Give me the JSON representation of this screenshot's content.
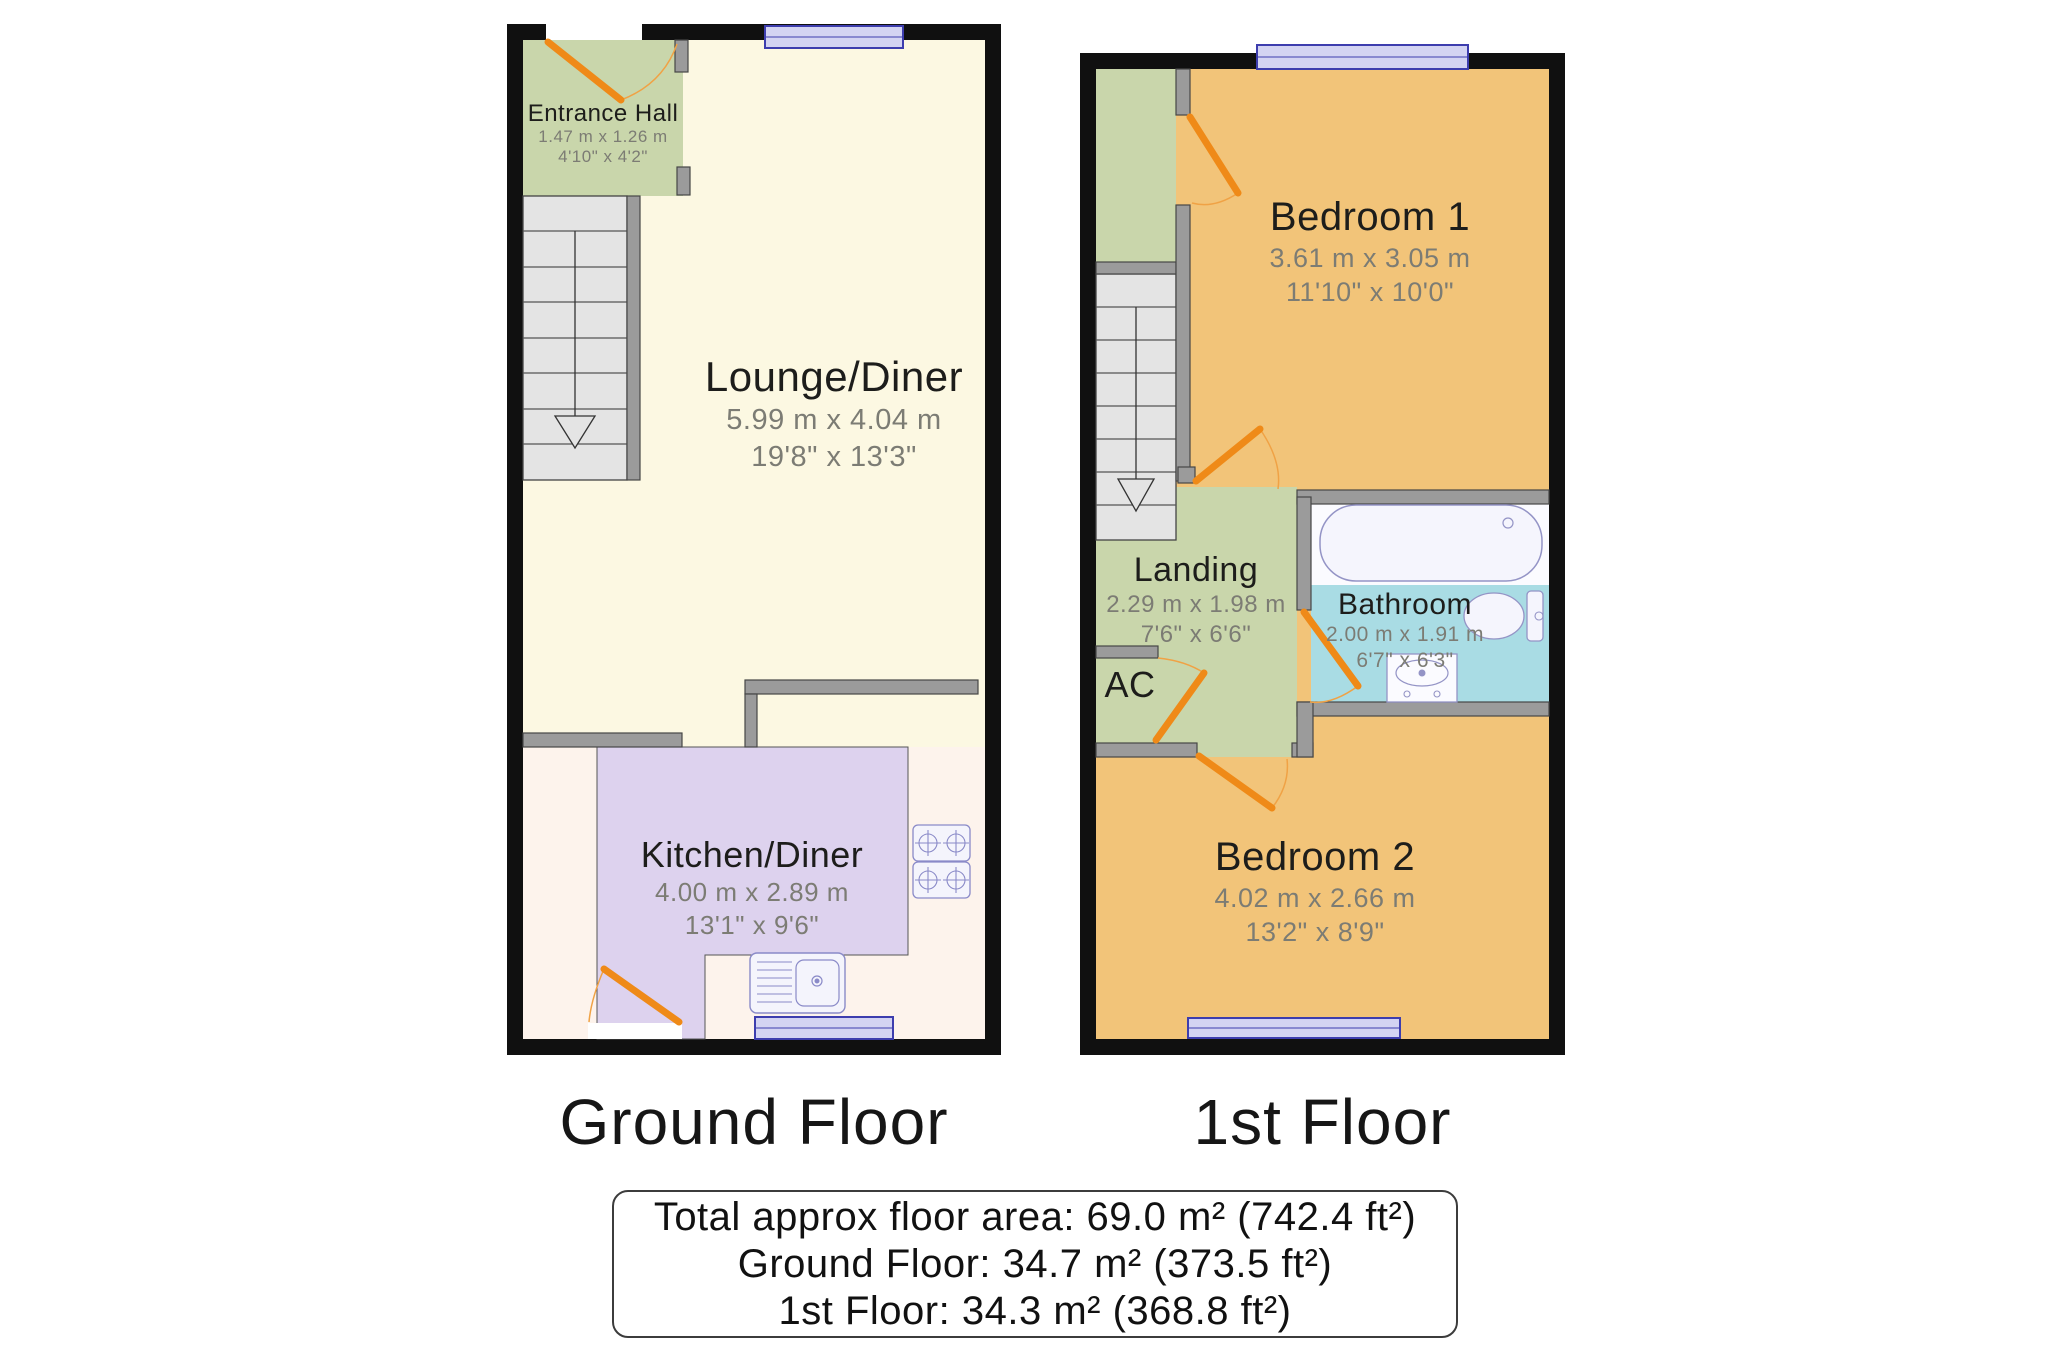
{
  "colors": {
    "outer_wall": "#101010",
    "internal_wall": "#9b9b9b",
    "hall_green": "#c9d6ab",
    "lounge_cream": "#fcf8e2",
    "kitchen_purple": "#ddd2ee",
    "kitchen_offwhite": "#fdf3ec",
    "bedroom_orange": "#f2c479",
    "bathroom_cyan": "#a9dce4",
    "door_orange": "#ef8a18",
    "window_lavender": "#d3d3f2",
    "stairs_gray": "#e4e4e4"
  },
  "ground_floor": {
    "caption": "Ground Floor",
    "rooms": {
      "entrance_hall": {
        "name": "Entrance Hall",
        "metric": "1.47 m x 1.26 m",
        "imperial": "4'10\" x 4'2\""
      },
      "lounge_diner": {
        "name": "Lounge/Diner",
        "metric": "5.99 m x 4.04 m",
        "imperial": "19'8\" x 13'3\""
      },
      "kitchen_diner": {
        "name": "Kitchen/Diner",
        "metric": "4.00 m x 2.89 m",
        "imperial": "13'1\" x 9'6\""
      }
    }
  },
  "first_floor": {
    "caption": "1st Floor",
    "rooms": {
      "bedroom_1": {
        "name": "Bedroom 1",
        "metric": "3.61 m x 3.05 m",
        "imperial": "11'10\" x 10'0\""
      },
      "landing": {
        "name": "Landing",
        "metric": "2.29 m x 1.98 m",
        "imperial": "7'6\" x 6'6\""
      },
      "bathroom": {
        "name": "Bathroom",
        "metric": "2.00 m x 1.91 m",
        "imperial": "6'7\" x 6'3\""
      },
      "airing_cupboard": {
        "name": "AC"
      },
      "bedroom_2": {
        "name": "Bedroom 2",
        "metric": "4.02 m x 2.66 m",
        "imperial": "13'2\" x 8'9\""
      }
    }
  },
  "summary": {
    "total": "Total approx floor area: 69.0 m² (742.4 ft²)",
    "ground": "Ground Floor: 34.7 m² (373.5 ft²)",
    "first": "1st Floor: 34.3 m² (368.8 ft²)"
  }
}
